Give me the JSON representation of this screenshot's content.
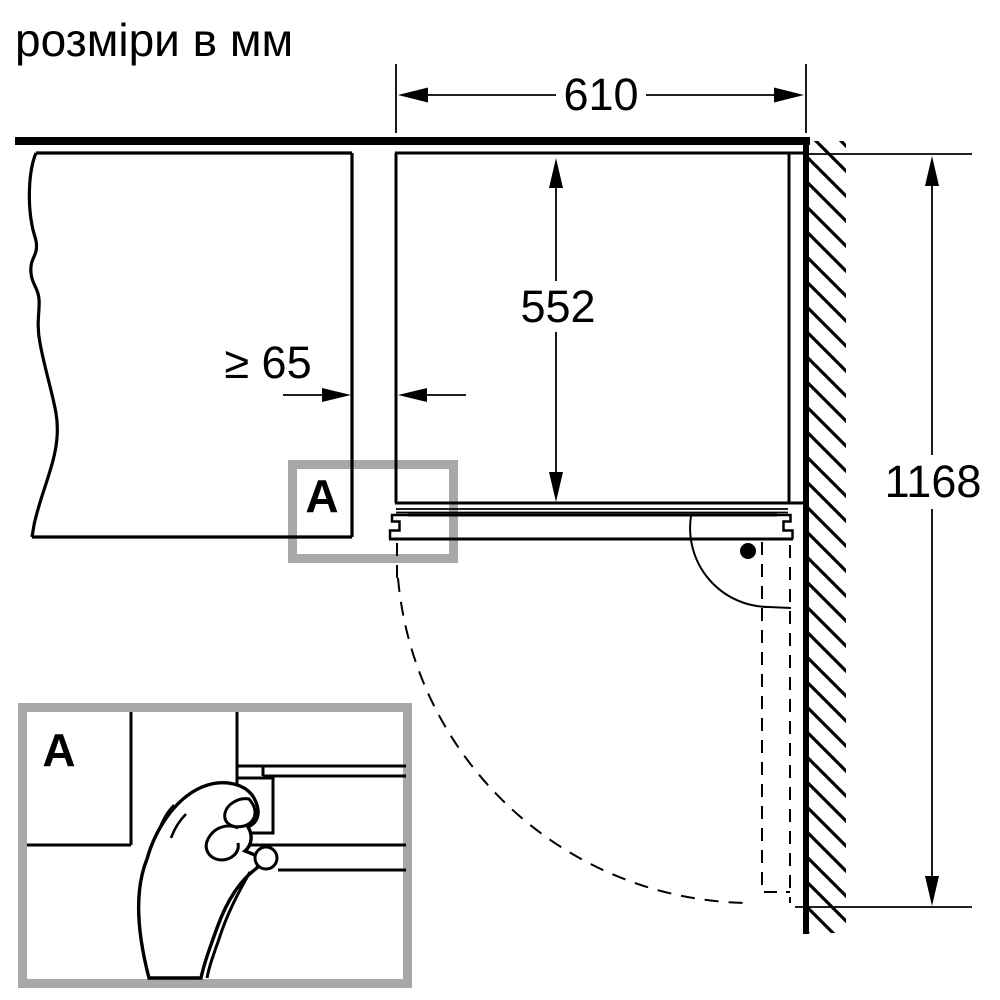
{
  "title": "розміри в мм",
  "dimensions": {
    "width_top": "610",
    "niche_height": "552",
    "min_side_clearance": "≥ 65",
    "total_height": "1168"
  },
  "detail_label": "A",
  "colors": {
    "line": "#000000",
    "detail_frame_gray": "#a8a8a8",
    "background": "#ffffff"
  }
}
